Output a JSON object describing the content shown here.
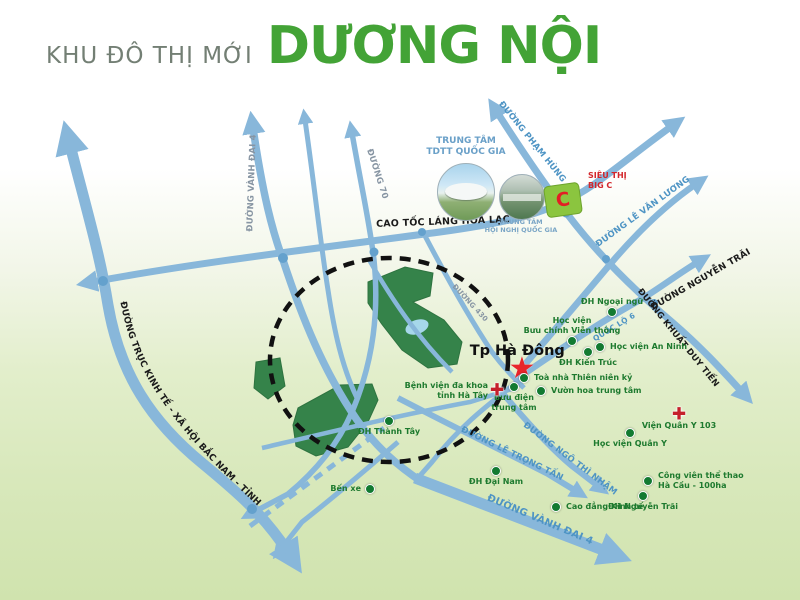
{
  "title": {
    "prefix": "KHU ĐÔ THỊ MỚI",
    "name": "DƯƠNG NỘI"
  },
  "colors": {
    "road_blue": "#88b7da",
    "road_node": "#64a1cd",
    "label_blue": "#4e94c4",
    "label_grayblue": "#8795a3",
    "label_black": "#1a1a1a",
    "poi_green": "#1e7a2f",
    "marker_green": "#127a31",
    "red": "#d42127",
    "green_area": "#35834a",
    "title_green": "#43a336"
  },
  "truc_label": "ĐƯỜNG TRỤC KINH TẾ - XÃ HỘI BẮC NAM - TỈNH HÀ TÂY",
  "road_labels": [
    {
      "id": "vanh-dai-4-top",
      "label": "ĐƯỜNG VÀNH ĐAI 4",
      "x": 252,
      "y": 183,
      "rotate": -88,
      "color": "grayblue",
      "size": 8.5
    },
    {
      "id": "duong-70",
      "label": "ĐƯỜNG 70",
      "x": 377,
      "y": 174,
      "rotate": 72,
      "color": "grayblue",
      "size": 8.5
    },
    {
      "id": "cao-toc-lang-hoa-lac",
      "label": "CAO TỐC LÁNG HOÀ LẠC",
      "x": 443,
      "y": 222,
      "rotate": -2,
      "color": "black",
      "size": 9.5
    },
    {
      "id": "pham-hung",
      "label": "ĐƯỜNG PHẠM HÙNG",
      "x": 532,
      "y": 142,
      "rotate": 51,
      "color": "blue",
      "size": 8.5
    },
    {
      "id": "le-van-luong",
      "label": "ĐƯỜNG LÊ VĂN LƯƠNG",
      "x": 643,
      "y": 212,
      "rotate": -36,
      "color": "blue",
      "size": 8.5
    },
    {
      "id": "nguyen-trai",
      "label": "ĐƯỜNG NGUYỄN TRÃI",
      "x": 701,
      "y": 280,
      "rotate": -30,
      "color": "black",
      "size": 9
    },
    {
      "id": "khuat-duy-tien",
      "label": "ĐƯỜNG KHUẤT DUY TIẾN",
      "x": 678,
      "y": 338,
      "rotate": 51,
      "color": "black",
      "size": 8.5
    },
    {
      "id": "quoc-lo-6",
      "label": "QUỐC LỘ 6",
      "x": 614,
      "y": 327,
      "rotate": -31,
      "color": "blue",
      "size": 7.5
    },
    {
      "id": "duong-430",
      "label": "ĐƯỜNG 430",
      "x": 470,
      "y": 303,
      "rotate": 47,
      "color": "grayblue",
      "size": 7
    },
    {
      "id": "le-trong-tan",
      "label": "ĐƯỜNG LÊ TRỌNG TẤN",
      "x": 512,
      "y": 454,
      "rotate": 26,
      "color": "blue",
      "size": 8.5
    },
    {
      "id": "ngo-thi-nham",
      "label": "ĐƯỜNG NGÔ THÌ NHẬM",
      "x": 570,
      "y": 459,
      "rotate": 37,
      "color": "blue",
      "size": 8.5
    },
    {
      "id": "vanh-dai-4-bottom",
      "label": "ĐƯỜNG VÀNH ĐAI 4",
      "x": 540,
      "y": 520,
      "rotate": 23,
      "color": "blue",
      "size": 10
    }
  ],
  "pois": [
    {
      "id": "tp-ha-dong",
      "lines": [
        "Tp Hà Đông"
      ],
      "marker": "star",
      "x": 522,
      "y": 369,
      "label_pos": "above",
      "style": "city"
    },
    {
      "id": "dh-ngoai-ngu",
      "lines": [
        "ĐH Ngoại ngữ"
      ],
      "marker": "dot",
      "x": 612,
      "y": 312,
      "label_pos": "above"
    },
    {
      "id": "hv-buu-chinh",
      "lines": [
        "Học viện",
        "Bưu chính Viễn thông"
      ],
      "marker": "dot",
      "x": 572,
      "y": 341,
      "label_pos": "above"
    },
    {
      "id": "hv-an-ninh",
      "lines": [
        "Học viện An Ninh"
      ],
      "marker": "dot",
      "x": 600,
      "y": 347,
      "label_pos": "right"
    },
    {
      "id": "dh-kien-truc",
      "lines": [
        "ĐH Kiến Trúc"
      ],
      "marker": "dot",
      "x": 588,
      "y": 352,
      "label_pos": "below"
    },
    {
      "id": "toa-nha-thien-nien-ky",
      "lines": [
        "Toà nhà Thiên niên kỷ"
      ],
      "marker": "dot",
      "x": 524,
      "y": 378,
      "label_pos": "right"
    },
    {
      "id": "vuon-hoa-trung-tam",
      "lines": [
        "Vườn hoa trung tâm"
      ],
      "marker": "dot",
      "x": 541,
      "y": 391,
      "label_pos": "right"
    },
    {
      "id": "buu-dien-trung-tam",
      "lines": [
        "Bưu điện",
        "trung tâm"
      ],
      "marker": "dot",
      "x": 514,
      "y": 387,
      "label_pos": "below"
    },
    {
      "id": "benh-vien-ha-tay",
      "lines": [
        "Bệnh viện đa khoa",
        "tỉnh Hà Tây"
      ],
      "marker": "cross",
      "x": 497,
      "y": 391,
      "label_pos": "left"
    },
    {
      "id": "dh-thanh-tay",
      "lines": [
        "ĐH Thành Tây"
      ],
      "marker": "dot",
      "x": 389,
      "y": 421,
      "label_pos": "below"
    },
    {
      "id": "ben-xe",
      "lines": [
        "Bến xe"
      ],
      "marker": "dot",
      "x": 370,
      "y": 489,
      "label_pos": "left"
    },
    {
      "id": "dh-dai-nam",
      "lines": [
        "ĐH Đại Nam"
      ],
      "marker": "dot",
      "x": 496,
      "y": 471,
      "label_pos": "below"
    },
    {
      "id": "cao-dang-kinh-te",
      "lines": [
        "Cao đẳng Kinh tế"
      ],
      "marker": "dot",
      "x": 556,
      "y": 507,
      "label_pos": "right"
    },
    {
      "id": "dh-nguyen-trai",
      "lines": [
        "ĐH Nguyễn Trãi"
      ],
      "marker": "dot",
      "x": 643,
      "y": 496,
      "label_pos": "below"
    },
    {
      "id": "cong-vien-the-thao",
      "lines": [
        "Công viên thể thao",
        "Hà Cầu - 100ha"
      ],
      "marker": "dot",
      "x": 648,
      "y": 481,
      "label_pos": "right"
    },
    {
      "id": "hoc-vien-quan-y",
      "lines": [
        "Học viện Quân Y"
      ],
      "marker": "dot",
      "x": 630,
      "y": 433,
      "label_pos": "below"
    },
    {
      "id": "vien-quan-y-103",
      "lines": [
        "Viện Quân Y 103"
      ],
      "marker": "cross",
      "x": 679,
      "y": 415,
      "label_pos": "below"
    }
  ],
  "landmarks": {
    "stadium": {
      "lines": [
        "TRUNG TÂM",
        "TDTT QUỐC GIA"
      ]
    },
    "convention": {
      "lines": [
        "TRUNG TÂM",
        "HỘI NGHỊ QUỐC GIA"
      ]
    },
    "bigc": {
      "lines": [
        "SIÊU THỊ",
        "BIG C"
      ],
      "letter": "C"
    }
  }
}
